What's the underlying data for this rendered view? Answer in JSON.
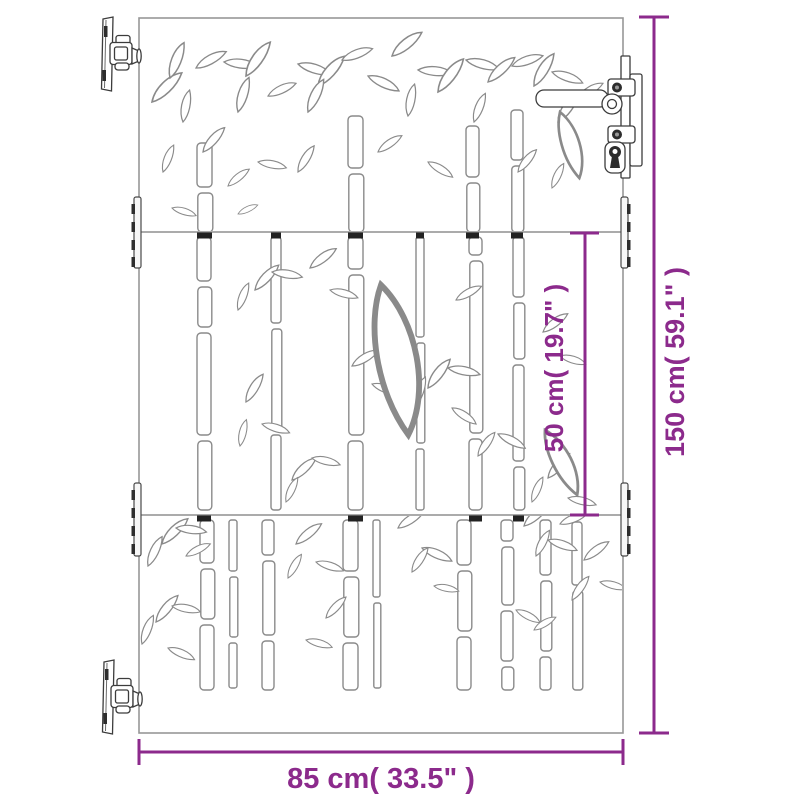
{
  "dimensions": {
    "height_label": "150 cm( 59.1\" )",
    "inner_height_label": "50 cm( 19.7\" )",
    "width_label": "85 cm( 33.5\" )"
  },
  "colors": {
    "dimension_accent": "#8c2a8c",
    "line_art": "#8a8a8a",
    "hardware_dark": "#2d2d2d",
    "background": "#ffffff"
  },
  "icons": {
    "hinge_top": "hinge-icon",
    "hinge_bottom": "hinge-icon",
    "handle": "door-handle-icon",
    "keyhole": "keyhole-icon",
    "pattern": "bamboo-pattern"
  }
}
